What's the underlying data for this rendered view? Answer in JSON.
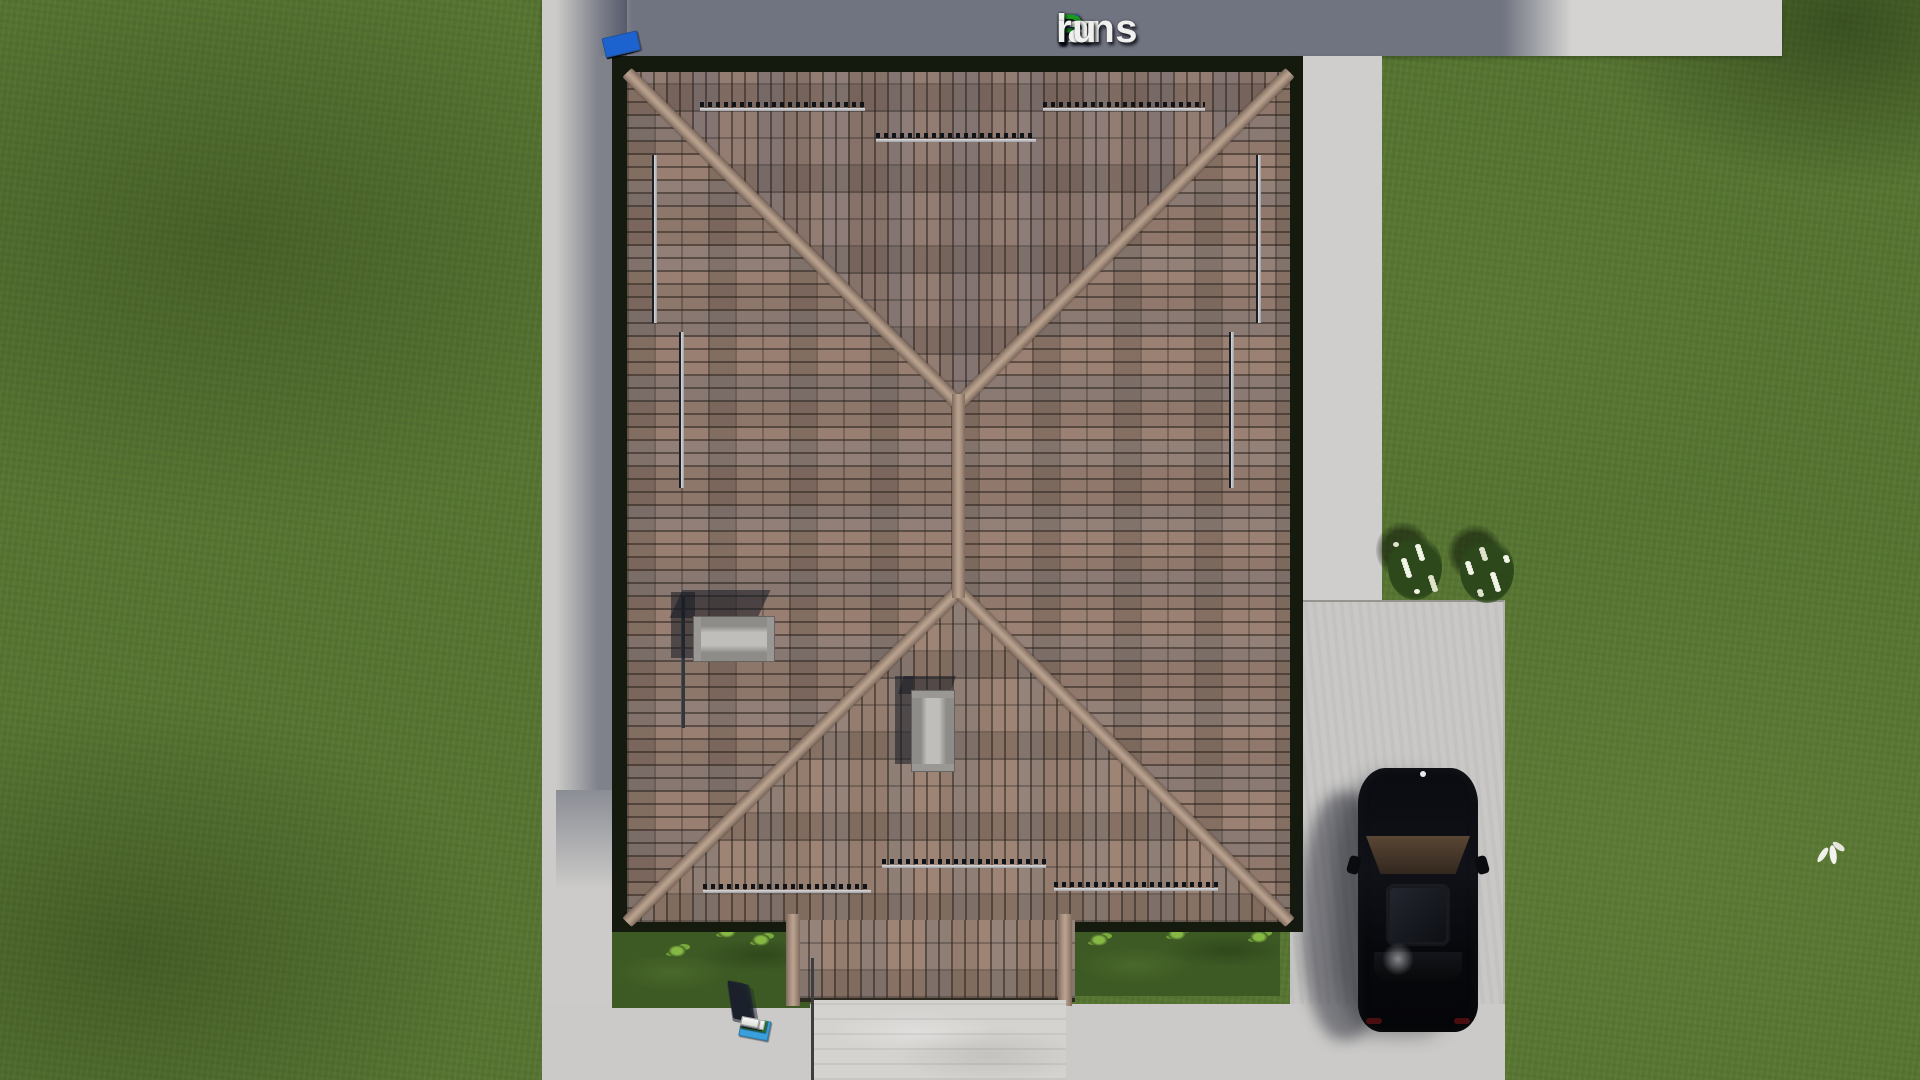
{
  "watermark": {
    "text": "FixPlans.ru",
    "segments": [
      {
        "t": "F",
        "c": "#2b59d8"
      },
      {
        "t": "ix",
        "c": "#f0f0ee"
      },
      {
        "t": "P",
        "c": "#1a9a1e"
      },
      {
        "t": "lans",
        "c": "#f0f0ee"
      },
      {
        "t": ".",
        "c": "#2b59d8"
      },
      {
        "t": "ru",
        "c": "#f0f0ee"
      }
    ]
  },
  "palette": {
    "grass": "#567431",
    "pavement": "#cccbc9",
    "pavement_shadow": "#596078",
    "roof_tile": "#8f786b",
    "roof_ridge": "#a8917f",
    "roof_frame": "#141a0e",
    "chimney": "#b5b3af",
    "car_body": "#0a0b10",
    "marker_white": "#f1f1ee",
    "marker_blue": "#1d63cf",
    "marker_green": "#2fa32a",
    "marker_lightblue": "#3aa0dc"
  },
  "markers": {
    "top_row": [
      {
        "w": 26,
        "h": 11,
        "c": "w"
      },
      {
        "w": 26,
        "h": 11,
        "c": "w"
      },
      {
        "w": 15,
        "h": 12,
        "c": "b"
      },
      {
        "w": 28,
        "h": 12,
        "c": "w"
      },
      {
        "w": 26,
        "h": 12,
        "c": "w"
      },
      {
        "w": 32,
        "h": 13,
        "c": "w"
      },
      {
        "w": 12,
        "h": 12,
        "c": "w"
      },
      {
        "w": 34,
        "h": 14,
        "c": "g"
      },
      {
        "w": 28,
        "h": 14,
        "c": "w"
      },
      {
        "w": 12,
        "h": 14,
        "c": "g"
      },
      {
        "w": 36,
        "h": 20,
        "c": "b"
      }
    ],
    "bottom_row": [
      {
        "w": 30,
        "h": 20,
        "c": "lb"
      },
      {
        "w": 13,
        "h": 11,
        "c": "g"
      },
      {
        "w": 24,
        "h": 11,
        "c": "w"
      },
      {
        "w": 26,
        "h": 12,
        "c": "g"
      },
      {
        "w": 22,
        "h": 10,
        "c": "w"
      },
      {
        "w": 22,
        "h": 10,
        "c": "w"
      },
      {
        "w": 20,
        "h": 10,
        "c": "w"
      },
      {
        "w": 14,
        "h": 10,
        "c": "b"
      },
      {
        "w": 24,
        "h": 10,
        "c": "w"
      },
      {
        "w": 18,
        "h": 9,
        "c": "w"
      }
    ]
  },
  "scene": {
    "objects": [
      "hip-roof",
      "chimney",
      "snow-guards",
      "porch-roof",
      "entrance-steps",
      "walkway",
      "driveway",
      "black-car",
      "lawn",
      "flower-bushes",
      "flying-bird"
    ],
    "tufts": [
      [
        668,
        945
      ],
      [
        718,
        926
      ],
      [
        752,
        934
      ],
      [
        1090,
        934
      ],
      [
        1168,
        928
      ],
      [
        1250,
        931
      ]
    ],
    "bushes": [
      [
        1388,
        534
      ],
      [
        1460,
        537
      ]
    ],
    "flowers_per_bush": 18
  }
}
